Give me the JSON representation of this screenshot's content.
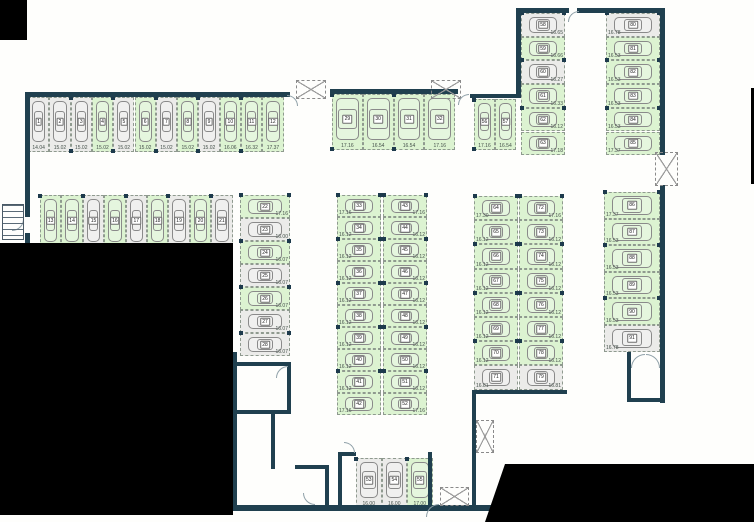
{
  "plan": {
    "colors": {
      "free": "#dcf3d1",
      "occupied": "#ebebe9",
      "wall": "#20404f",
      "void": "#000000"
    },
    "groups": [
      {
        "id": "row-top-left",
        "orientation": "v",
        "direction": "row",
        "x": 28,
        "y": 97,
        "cell_w": 21.3,
        "cell_h": 55,
        "label_side": "bottom",
        "spaces": [
          {
            "n": "1",
            "size": "14.04",
            "free": false
          },
          {
            "n": "2",
            "size": "15.02",
            "free": false
          },
          {
            "n": "3",
            "size": "15.02",
            "free": false
          },
          {
            "n": "4",
            "size": "15.02",
            "free": true
          },
          {
            "n": "5",
            "size": "15.02",
            "free": false
          },
          {
            "n": "6",
            "size": "15.02",
            "free": true
          },
          {
            "n": "7",
            "size": "15.02",
            "free": false
          },
          {
            "n": "8",
            "size": "15.02",
            "free": true
          },
          {
            "n": "9",
            "size": "15.02",
            "free": false
          },
          {
            "n": "10",
            "size": "16.06",
            "free": true
          },
          {
            "n": "11",
            "size": "16.32",
            "free": true
          },
          {
            "n": "12",
            "size": "17.37",
            "free": true
          }
        ]
      },
      {
        "id": "row-top-center",
        "orientation": "v",
        "direction": "row",
        "x": 332,
        "y": 94,
        "cell_w": 30.8,
        "cell_h": 56,
        "label_side": "bottom",
        "spaces": [
          {
            "n": "29",
            "size": "17.16",
            "free": true
          },
          {
            "n": "30",
            "size": "16.54",
            "free": true
          },
          {
            "n": "31",
            "size": "16.54",
            "free": true
          },
          {
            "n": "32",
            "size": "17.16",
            "free": true
          }
        ]
      },
      {
        "id": "row-second-left",
        "orientation": "v",
        "direction": "row",
        "x": 40,
        "y": 195,
        "cell_w": 21.4,
        "cell_h": 57,
        "label_side": "bottom",
        "spaces": [
          {
            "n": "13",
            "size": "20.27",
            "free": true
          },
          {
            "n": "14",
            "size": "16.67",
            "free": true
          },
          {
            "n": "15",
            "size": "16.67",
            "free": false
          },
          {
            "n": "16",
            "size": "16.67",
            "free": true
          },
          {
            "n": "17",
            "size": "16.67",
            "free": false
          },
          {
            "n": "18",
            "size": "16.67",
            "free": true
          },
          {
            "n": "19",
            "size": "16.67",
            "free": false
          },
          {
            "n": "20",
            "size": "16.67",
            "free": true
          },
          {
            "n": "21",
            "size": "16.67",
            "free": false
          }
        ]
      },
      {
        "id": "col-left",
        "orientation": "h",
        "direction": "col",
        "x": 240,
        "y": 195,
        "cell_w": 50,
        "cell_h": 23,
        "label_side": "right",
        "spaces": [
          {
            "n": "22",
            "size": "17.16",
            "free": true
          },
          {
            "n": "23",
            "size": "16.00",
            "free": false
          },
          {
            "n": "24",
            "size": "16.07",
            "free": true
          },
          {
            "n": "25",
            "size": "16.07",
            "free": false
          },
          {
            "n": "26",
            "size": "16.07",
            "free": true
          },
          {
            "n": "27",
            "size": "16.07",
            "free": false
          },
          {
            "n": "28",
            "size": "16.07",
            "free": false
          }
        ]
      },
      {
        "id": "block-center-west",
        "orientation": "h",
        "direction": "col",
        "x": 337,
        "y": 195,
        "cell_w": 44,
        "cell_h": 22,
        "label_side": "left",
        "spaces": [
          {
            "n": "33",
            "size": "17.16",
            "free": true
          },
          {
            "n": "34",
            "size": "16.12",
            "free": true
          },
          {
            "n": "35",
            "size": "16.12",
            "free": true
          },
          {
            "n": "36",
            "size": "16.12",
            "free": true
          },
          {
            "n": "37",
            "size": "16.12",
            "free": true
          },
          {
            "n": "38",
            "size": "16.12",
            "free": true
          },
          {
            "n": "39",
            "size": "16.12",
            "free": true
          },
          {
            "n": "40",
            "size": "16.12",
            "free": true
          },
          {
            "n": "41",
            "size": "16.12",
            "free": true
          },
          {
            "n": "42",
            "size": "17.16",
            "free": true
          }
        ]
      },
      {
        "id": "block-center-east",
        "orientation": "h",
        "direction": "col",
        "x": 383,
        "y": 195,
        "cell_w": 44,
        "cell_h": 22,
        "label_side": "right",
        "spaces": [
          {
            "n": "43",
            "size": "17.16",
            "free": true
          },
          {
            "n": "44",
            "size": "16.12",
            "free": true
          },
          {
            "n": "45",
            "size": "16.12",
            "free": true
          },
          {
            "n": "46",
            "size": "16.12",
            "free": true
          },
          {
            "n": "47",
            "size": "16.12",
            "free": true
          },
          {
            "n": "48",
            "size": "16.12",
            "free": true
          },
          {
            "n": "49",
            "size": "16.12",
            "free": true
          },
          {
            "n": "50",
            "size": "16.12",
            "free": true
          },
          {
            "n": "51",
            "size": "16.12",
            "free": true
          },
          {
            "n": "52",
            "size": "17.16",
            "free": true
          }
        ]
      },
      {
        "id": "row-bottom-center",
        "orientation": "v",
        "direction": "row",
        "x": 356,
        "y": 458,
        "cell_w": 25.5,
        "cell_h": 50,
        "label_side": "bottom",
        "spaces": [
          {
            "n": "53",
            "size": "16.00",
            "free": false
          },
          {
            "n": "54",
            "size": "16.00",
            "free": false
          },
          {
            "n": "55",
            "size": "17.00",
            "free": true
          }
        ]
      },
      {
        "id": "pair-upper-right",
        "orientation": "v",
        "direction": "row",
        "x": 474,
        "y": 99,
        "cell_w": 21,
        "cell_h": 51,
        "label_side": "bottom",
        "spaces": [
          {
            "n": "56",
            "size": "17.16",
            "free": true
          },
          {
            "n": "57",
            "size": "16.54",
            "free": true
          }
        ]
      },
      {
        "id": "col-wing-west",
        "orientation": "h",
        "direction": "col",
        "x": 521,
        "y": 13,
        "cell_w": 44,
        "cell_h": 23.7,
        "label_side": "right",
        "spaces": [
          {
            "n": "58",
            "size": "16.65",
            "free": false
          },
          {
            "n": "59",
            "size": "16.66",
            "free": true
          },
          {
            "n": "60",
            "size": "16.27",
            "free": false
          },
          {
            "n": "61",
            "size": "16.33",
            "free": true
          },
          {
            "n": "62",
            "size": "16.12",
            "free": true
          },
          {
            "n": "63",
            "size": "17.18",
            "free": true
          }
        ]
      },
      {
        "id": "col-wing-east",
        "orientation": "h",
        "direction": "col",
        "x": 606,
        "y": 13,
        "cell_w": 54,
        "cell_h": 23.7,
        "label_side": "left",
        "spaces": [
          {
            "n": "80",
            "size": "16.78",
            "free": false
          },
          {
            "n": "81",
            "size": "16.53",
            "free": true
          },
          {
            "n": "82",
            "size": "16.53",
            "free": true
          },
          {
            "n": "83",
            "size": "16.53",
            "free": true
          },
          {
            "n": "84",
            "size": "16.53",
            "free": true
          },
          {
            "n": "85",
            "size": "17.37",
            "free": true
          }
        ]
      },
      {
        "id": "block-right-west",
        "orientation": "h",
        "direction": "col",
        "x": 474,
        "y": 196,
        "cell_w": 44,
        "cell_h": 24.2,
        "label_side": "left",
        "spaces": [
          {
            "n": "64",
            "size": "17.30",
            "free": true
          },
          {
            "n": "65",
            "size": "16.12",
            "free": true
          },
          {
            "n": "66",
            "size": "16.12",
            "free": true
          },
          {
            "n": "67",
            "size": "16.12",
            "free": true
          },
          {
            "n": "68",
            "size": "16.12",
            "free": true
          },
          {
            "n": "69",
            "size": "16.12",
            "free": true
          },
          {
            "n": "70",
            "size": "16.12",
            "free": true
          },
          {
            "n": "71",
            "size": "16.81",
            "free": false
          }
        ]
      },
      {
        "id": "block-right-east",
        "orientation": "h",
        "direction": "col",
        "x": 519,
        "y": 196,
        "cell_w": 44,
        "cell_h": 24.2,
        "label_side": "right",
        "spaces": [
          {
            "n": "72",
            "size": "17.16",
            "free": true
          },
          {
            "n": "73",
            "size": "16.12",
            "free": true
          },
          {
            "n": "74",
            "size": "16.12",
            "free": true
          },
          {
            "n": "75",
            "size": "16.12",
            "free": true
          },
          {
            "n": "76",
            "size": "16.12",
            "free": true
          },
          {
            "n": "77",
            "size": "16.12",
            "free": true
          },
          {
            "n": "78",
            "size": "16.12",
            "free": true
          },
          {
            "n": "79",
            "size": "16.81",
            "free": false
          }
        ]
      },
      {
        "id": "col-far-right",
        "orientation": "h",
        "direction": "col",
        "x": 604,
        "y": 192,
        "cell_w": 56,
        "cell_h": 26.6,
        "label_side": "left",
        "spaces": [
          {
            "n": "86",
            "size": "17.37",
            "free": true
          },
          {
            "n": "87",
            "size": "16.53",
            "free": true
          },
          {
            "n": "88",
            "size": "16.53",
            "free": true
          },
          {
            "n": "89",
            "size": "16.53",
            "free": true
          },
          {
            "n": "90",
            "size": "16.53",
            "free": true
          },
          {
            "n": "91",
            "size": "16.78",
            "free": false
          }
        ]
      }
    ],
    "structure": {
      "walls": [
        [
          25,
          92,
          265,
          5
        ],
        [
          25,
          92,
          5,
          125
        ],
        [
          25,
          233,
          5,
          12
        ],
        [
          330,
          89,
          128,
          5
        ],
        [
          470,
          94,
          50,
          4
        ],
        [
          516,
          8,
          5,
          90
        ],
        [
          516,
          8,
          53,
          5
        ],
        [
          577,
          8,
          88,
          5
        ],
        [
          660,
          8,
          5,
          147
        ],
        [
          660,
          185,
          5,
          218
        ],
        [
          472,
          390,
          95,
          4
        ],
        [
          472,
          390,
          4,
          118
        ],
        [
          233,
          505,
          260,
          6
        ],
        [
          233,
          352,
          4,
          157
        ],
        [
          233,
          362,
          58,
          4
        ],
        [
          287,
          362,
          4,
          52
        ],
        [
          233,
          410,
          58,
          4
        ],
        [
          271,
          414,
          4,
          55
        ],
        [
          295,
          465,
          34,
          4
        ],
        [
          325,
          465,
          4,
          42
        ],
        [
          338,
          452,
          18,
          4
        ],
        [
          338,
          452,
          4,
          56
        ],
        [
          428,
          452,
          4,
          56
        ],
        [
          627,
          352,
          4,
          50
        ],
        [
          627,
          398,
          37,
          4
        ]
      ],
      "shafts": [
        [
          296,
          80,
          30,
          19
        ],
        [
          431,
          80,
          30,
          19
        ],
        [
          655,
          152,
          23,
          34
        ],
        [
          476,
          420,
          18,
          33
        ],
        [
          440,
          487,
          29,
          19
        ]
      ],
      "doors": [
        [
          287,
          95,
          11,
          90
        ],
        [
          458,
          94,
          11,
          0
        ],
        [
          568,
          11,
          11,
          0
        ],
        [
          12,
          219,
          12,
          180
        ],
        [
          276,
          366,
          12,
          0
        ],
        [
          303,
          493,
          12,
          270
        ],
        [
          344,
          442,
          11,
          90
        ],
        [
          426,
          504,
          13,
          0
        ],
        [
          631,
          354,
          14,
          0
        ],
        [
          646,
          354,
          14,
          90
        ]
      ],
      "stairs": [
        [
          2,
          204,
          22,
          36
        ]
      ],
      "voids": [
        {
          "x": 0,
          "y": 0,
          "w": 27,
          "h": 40
        },
        {
          "x": 0,
          "y": 243,
          "w": 233,
          "h": 272
        },
        {
          "x": 485,
          "y": 464,
          "w": 269,
          "h": 58,
          "clip": "polygon(20px 0, 269px 0, 269px 58px, 0 58px)"
        },
        {
          "x": 751,
          "y": 88,
          "w": 3,
          "h": 96
        }
      ]
    }
  }
}
